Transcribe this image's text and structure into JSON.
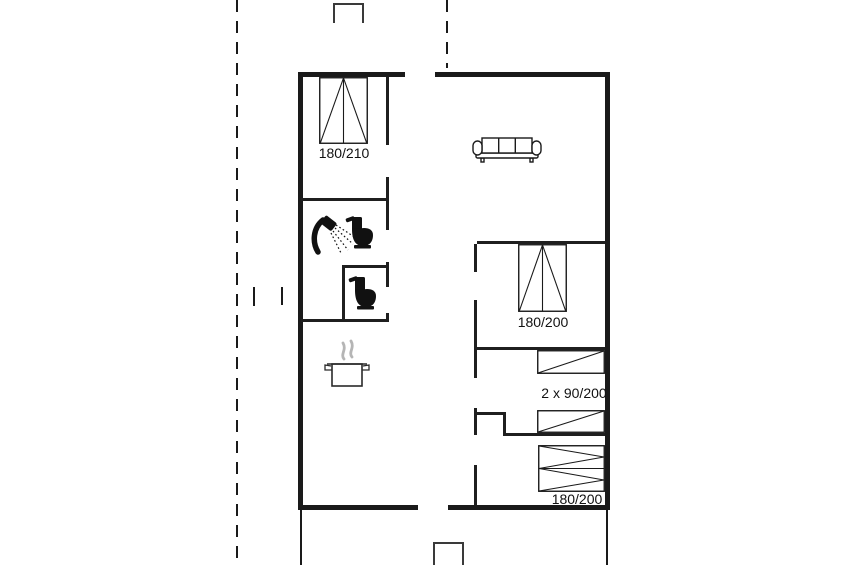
{
  "floor_plan": {
    "labels": {
      "bed_top_left": "180/210",
      "bed_middle_right": "180/200",
      "bunk_beds": "2 x 90/200",
      "bed_bottom_right": "180/200"
    },
    "icons": [
      {
        "name": "double-bed-icon",
        "area": "top-left-bedroom"
      },
      {
        "name": "sofa-icon",
        "area": "living-room"
      },
      {
        "name": "shower-icon",
        "area": "bathroom"
      },
      {
        "name": "toilet-icon",
        "area": "bathroom"
      },
      {
        "name": "toilet-icon",
        "area": "wc"
      },
      {
        "name": "cooking-pot-icon",
        "area": "kitchen"
      },
      {
        "name": "double-bed-icon",
        "area": "middle-bedroom"
      },
      {
        "name": "single-bed-icon",
        "area": "bunk-room"
      },
      {
        "name": "single-bed-icon",
        "area": "bunk-room"
      },
      {
        "name": "double-bed-icon",
        "area": "bottom-bedroom"
      }
    ],
    "colors": {
      "wall": "#1a1a1a",
      "background": "#ffffff",
      "steam": "#b5b5b5"
    }
  }
}
